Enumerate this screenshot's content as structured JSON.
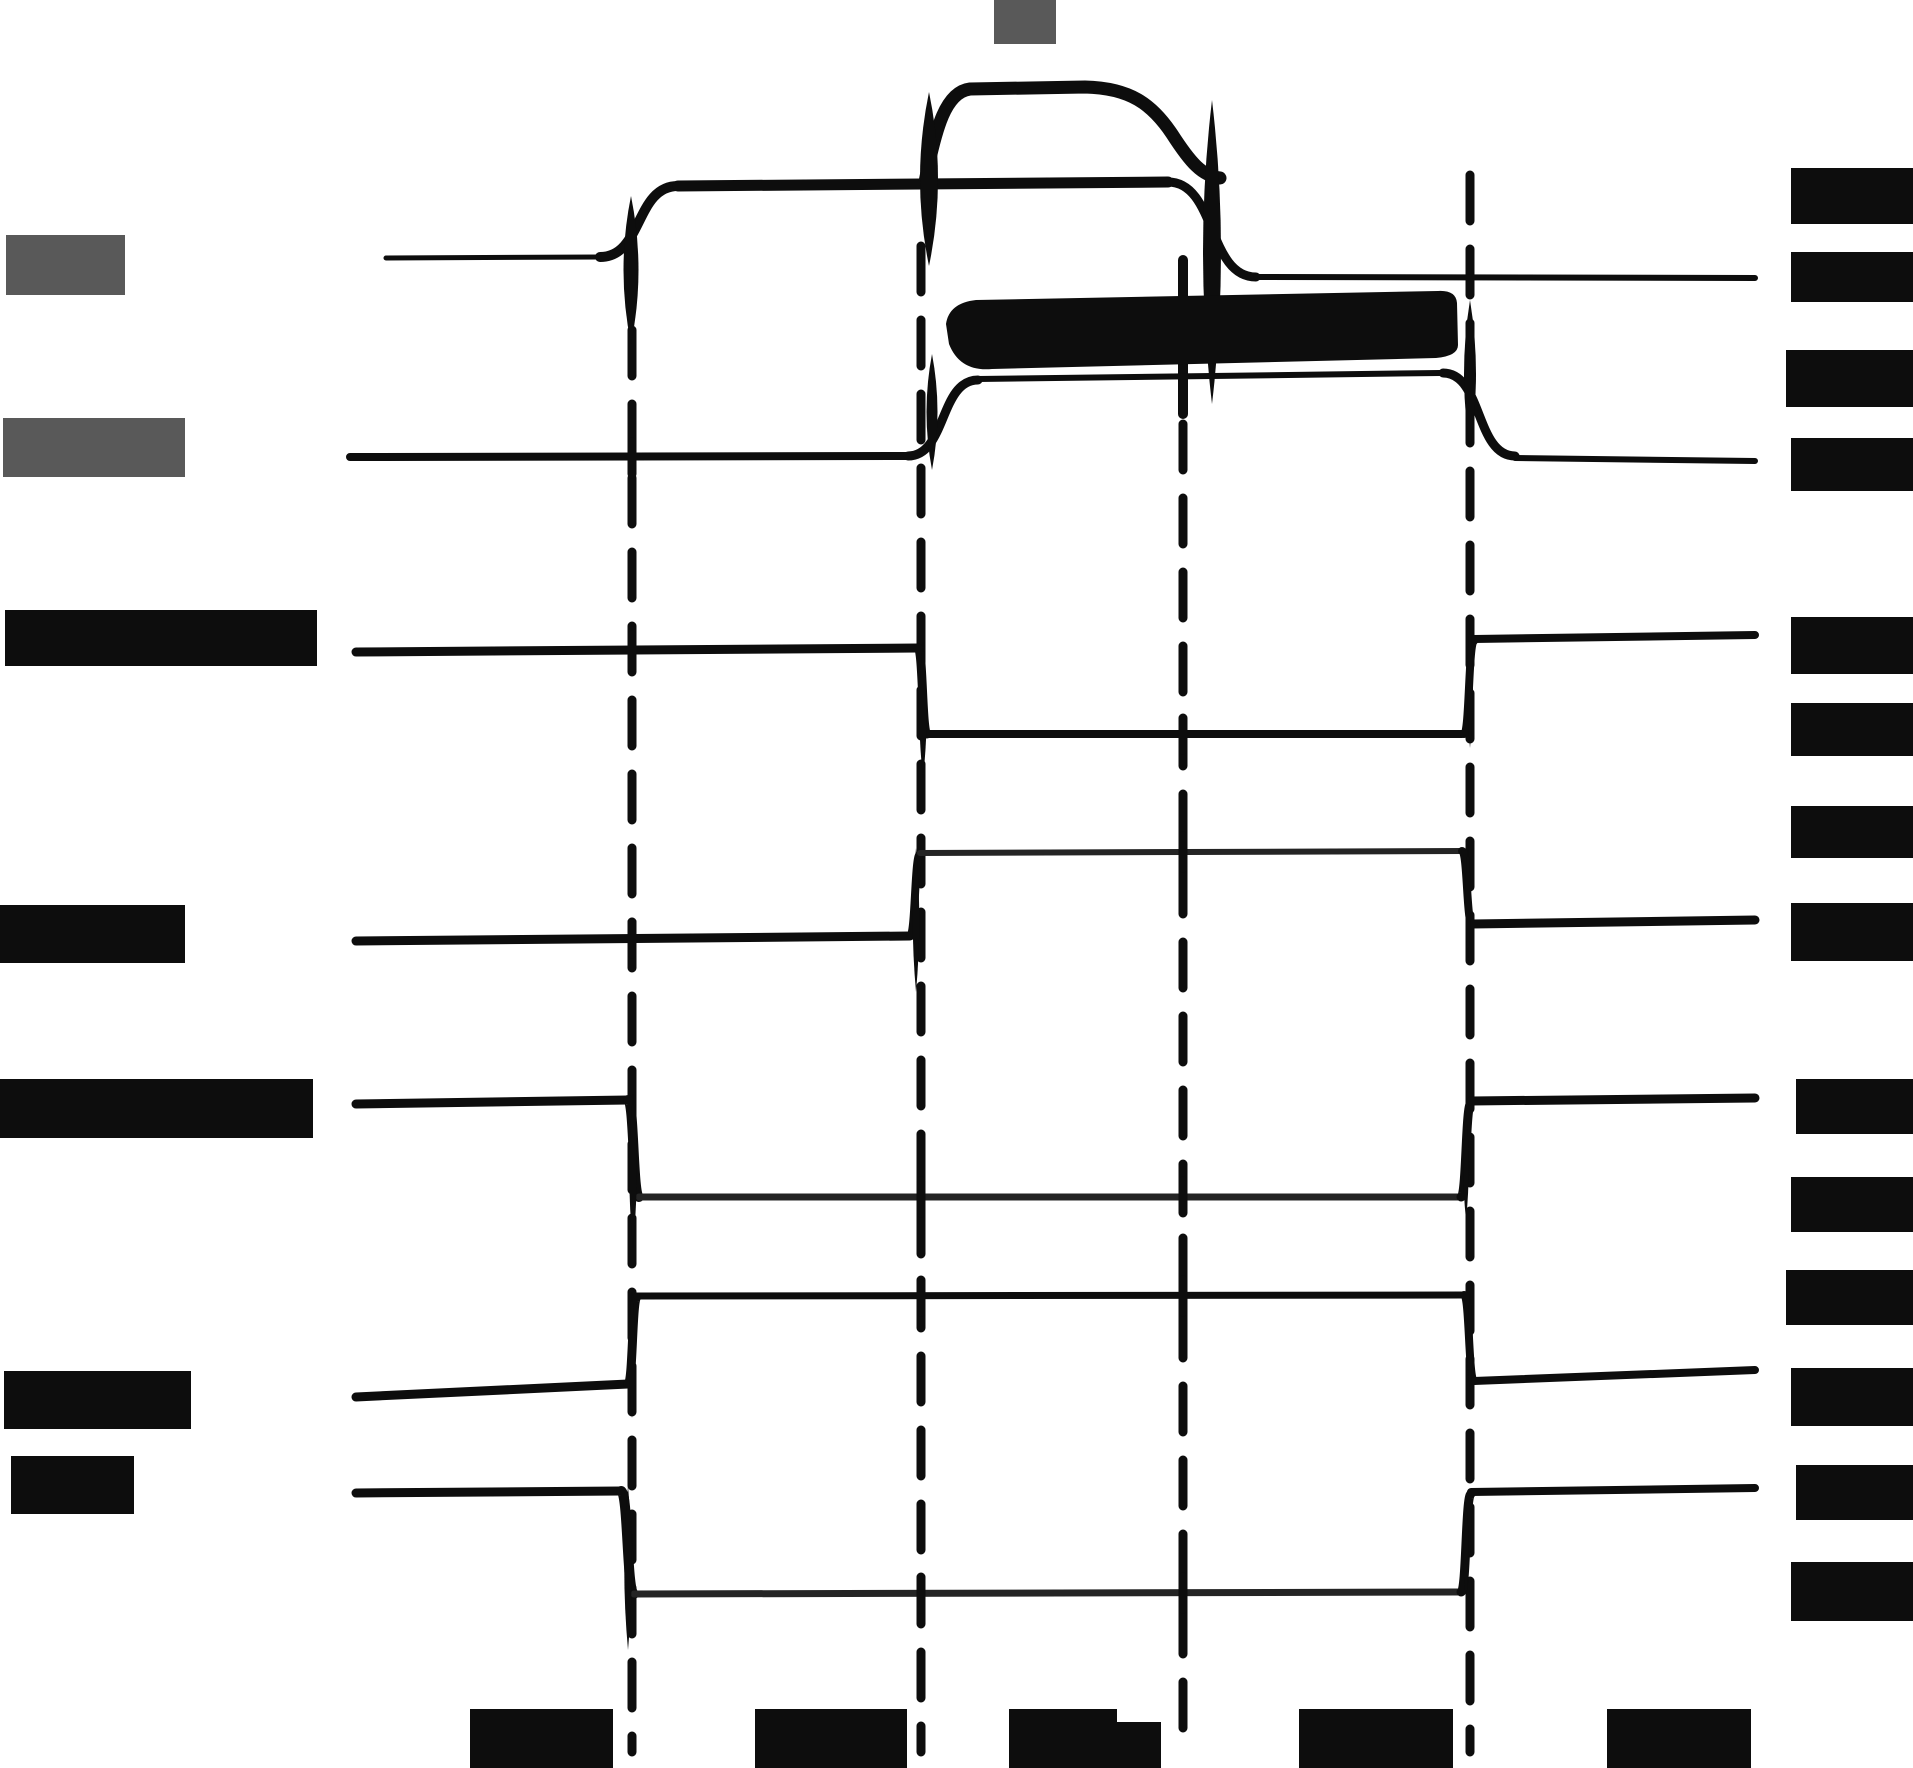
{
  "diagram": {
    "type": "scanned-timing-waveform-diagram",
    "width": 1913,
    "height": 1768,
    "background": "#ffffff",
    "visible_text": "none — every label in the scan is redacted with a solid block",
    "signal_count": 7,
    "timeline_marker_count": 4
  },
  "colors": {
    "ink": "#0d0d0d",
    "thin": "#242424",
    "gray_label": "#595959"
  },
  "timeline_markers": [
    {
      "x": 632,
      "from": 330,
      "to": 1752
    },
    {
      "x": 921,
      "from": 246,
      "to": 1752
    },
    {
      "x": 1183,
      "from": 424,
      "to": 1752,
      "solid": [
        260,
        414
      ]
    },
    {
      "x": 1470,
      "from": 175,
      "to": 1752
    }
  ],
  "crossing_ticks": [
    [
      632,
      458
    ],
    [
      632,
      651
    ],
    [
      632,
      938
    ],
    [
      921,
      1197
    ],
    [
      921,
      1296
    ],
    [
      921,
      1593
    ],
    [
      1183,
      734
    ],
    [
      1183,
      852
    ],
    [
      1183,
      1197
    ],
    [
      1183,
      1296
    ],
    [
      1183,
      1593
    ]
  ],
  "signals": [
    {
      "id": "signal-1-analog",
      "ops": [
        {
          "k": "line",
          "p": [
            386,
            258,
            600,
            257
          ],
          "w": 5
        },
        {
          "k": "edge",
          "p": [
            600,
            257,
            678,
            186
          ],
          "w": 10
        },
        {
          "k": "line",
          "p": [
            678,
            186,
            1168,
            182
          ],
          "w": 11
        },
        {
          "k": "edge",
          "p": [
            1168,
            182,
            1256,
            277
          ],
          "w": 9
        },
        {
          "k": "line",
          "p": [
            1256,
            277,
            1755,
            278
          ],
          "w": 6
        },
        {
          "k": "path",
          "d": "M 925 182 C 936 126 946 92 970 89 L 1085 87 C 1130 88 1152 104 1172 134 C 1190 162 1202 176 1220 178",
          "w": 13
        },
        {
          "k": "lens",
          "p": [
            631,
            196,
            344,
            30
          ]
        },
        {
          "k": "lens",
          "p": [
            929,
            92,
            266,
            36
          ]
        },
        {
          "k": "lens",
          "p": [
            1212,
            100,
            404,
            36
          ]
        }
      ]
    },
    {
      "id": "signal-2",
      "ops": [
        {
          "k": "line",
          "p": [
            350,
            457,
            908,
            456
          ],
          "w": 8
        },
        {
          "k": "edge",
          "p": [
            908,
            456,
            978,
            380
          ],
          "w": 9
        },
        {
          "k": "line",
          "p": [
            978,
            379,
            1440,
            373
          ],
          "w": 6
        },
        {
          "k": "edge",
          "p": [
            1443,
            373,
            1515,
            456
          ],
          "w": 9
        },
        {
          "k": "line",
          "p": [
            1515,
            458,
            1755,
            461
          ],
          "w": 6
        },
        {
          "k": "fill",
          "d": "M 946 324 Q 949 303 976 300 L 1438 291 Q 1456 290 1457 303 L 1458 345 Q 1458 356 1436 358 L 992 369 Q 960 372 949 344 Z"
        },
        {
          "k": "lens",
          "p": [
            932,
            354,
            470,
            22
          ]
        },
        {
          "k": "lens",
          "p": [
            1470,
            300,
            448,
            24
          ]
        }
      ]
    },
    {
      "id": "signal-3",
      "ops": [
        {
          "k": "line",
          "p": [
            356,
            652,
            918,
            648
          ],
          "w": 9
        },
        {
          "k": "edge",
          "p": [
            918,
            648,
            927,
            734
          ],
          "w": 9
        },
        {
          "k": "line",
          "p": [
            927,
            734,
            1462,
            734
          ],
          "w": 8
        },
        {
          "k": "edge",
          "p": [
            1464,
            734,
            1474,
            641
          ],
          "w": 8
        },
        {
          "k": "line",
          "p": [
            1474,
            639,
            1755,
            635
          ],
          "w": 8
        },
        {
          "k": "lens",
          "p": [
            923,
            642,
            778,
            15
          ]
        },
        {
          "k": "lens",
          "p": [
            1470,
            624,
            748,
            12
          ]
        }
      ]
    },
    {
      "id": "signal-4",
      "ops": [
        {
          "k": "line",
          "p": [
            356,
            941,
            910,
            936
          ],
          "w": 9
        },
        {
          "k": "edge",
          "p": [
            910,
            936,
            920,
            854
          ],
          "w": 8
        },
        {
          "k": "line",
          "p": [
            920,
            853,
            1462,
            851
          ],
          "w": 6,
          "c": "thin"
        },
        {
          "k": "edge",
          "p": [
            1462,
            851,
            1472,
            924
          ],
          "w": 8
        },
        {
          "k": "line",
          "p": [
            1472,
            924,
            1755,
            920
          ],
          "w": 9
        },
        {
          "k": "lens",
          "p": [
            916,
            848,
            992,
            13
          ]
        },
        {
          "k": "lens",
          "p": [
            1468,
            844,
            958,
            11
          ]
        }
      ]
    },
    {
      "id": "signal-5",
      "ops": [
        {
          "k": "line",
          "p": [
            356,
            1104,
            628,
            1100
          ],
          "w": 9
        },
        {
          "k": "edge",
          "p": [
            628,
            1100,
            639,
            1197
          ],
          "w": 10
        },
        {
          "k": "line",
          "p": [
            639,
            1197,
            1458,
            1197
          ],
          "w": 7,
          "c": "thin"
        },
        {
          "k": "edge",
          "p": [
            1461,
            1197,
            1471,
            1103
          ],
          "w": 9
        },
        {
          "k": "line",
          "p": [
            1471,
            1101,
            1755,
            1098
          ],
          "w": 9
        },
        {
          "k": "lens",
          "p": [
            633,
            1094,
            1248,
            15
          ]
        },
        {
          "k": "lens",
          "p": [
            1466,
            1112,
            1220,
            11
          ]
        }
      ]
    },
    {
      "id": "signal-6",
      "ops": [
        {
          "k": "line",
          "p": [
            356,
            1397,
            628,
            1384
          ],
          "w": 9
        },
        {
          "k": "edge",
          "p": [
            628,
            1384,
            637,
            1297
          ],
          "w": 9
        },
        {
          "k": "line",
          "p": [
            637,
            1296,
            1464,
            1295
          ],
          "w": 7
        },
        {
          "k": "edge",
          "p": [
            1464,
            1295,
            1474,
            1381
          ],
          "w": 8
        },
        {
          "k": "line",
          "p": [
            1474,
            1381,
            1755,
            1370
          ],
          "w": 8
        },
        {
          "k": "lens",
          "p": [
            632,
            1292,
            1418,
            13
          ]
        },
        {
          "k": "lens",
          "p": [
            1470,
            1294,
            1392,
            11
          ]
        }
      ]
    },
    {
      "id": "signal-7",
      "ops": [
        {
          "k": "line",
          "p": [
            356,
            1493,
            621,
            1491
          ],
          "w": 9
        },
        {
          "k": "edge",
          "p": [
            621,
            1491,
            634,
            1594
          ],
          "w": 10
        },
        {
          "k": "line",
          "p": [
            634,
            1594,
            1458,
            1592
          ],
          "w": 7,
          "c": "thin"
        },
        {
          "k": "edge",
          "p": [
            1461,
            1592,
            1471,
            1494
          ],
          "w": 9
        },
        {
          "k": "line",
          "p": [
            1471,
            1492,
            1755,
            1488
          ],
          "w": 8
        },
        {
          "k": "lens",
          "p": [
            628,
            1486,
            1650,
            15
          ]
        },
        {
          "k": "lens",
          "p": [
            1466,
            1502,
            1600,
            11
          ]
        }
      ]
    }
  ],
  "redacted_labels": {
    "top": [
      {
        "x": 994,
        "y": 0,
        "w": 62,
        "h": 44,
        "tone": "gray"
      }
    ],
    "left": [
      {
        "x": 6,
        "y": 235,
        "w": 119,
        "h": 60,
        "tone": "gray"
      },
      {
        "x": 3,
        "y": 418,
        "w": 182,
        "h": 59,
        "tone": "gray"
      },
      {
        "x": 5,
        "y": 610,
        "w": 312,
        "h": 56,
        "tone": "black"
      },
      {
        "x": 0,
        "y": 905,
        "w": 185,
        "h": 58,
        "tone": "black"
      },
      {
        "x": 0,
        "y": 1079,
        "w": 313,
        "h": 59,
        "tone": "black"
      },
      {
        "x": 4,
        "y": 1371,
        "w": 187,
        "h": 58,
        "tone": "black"
      },
      {
        "x": 11,
        "y": 1456,
        "w": 123,
        "h": 58,
        "tone": "black"
      }
    ],
    "right": [
      {
        "x": 1791,
        "y": 168,
        "w": 122,
        "h": 56,
        "tone": "black"
      },
      {
        "x": 1791,
        "y": 252,
        "w": 122,
        "h": 50,
        "tone": "black"
      },
      {
        "x": 1786,
        "y": 350,
        "w": 127,
        "h": 57,
        "tone": "black"
      },
      {
        "x": 1791,
        "y": 438,
        "w": 122,
        "h": 53,
        "tone": "black"
      },
      {
        "x": 1791,
        "y": 617,
        "w": 122,
        "h": 57,
        "tone": "black"
      },
      {
        "x": 1791,
        "y": 703,
        "w": 122,
        "h": 53,
        "tone": "black"
      },
      {
        "x": 1791,
        "y": 806,
        "w": 122,
        "h": 52,
        "tone": "black"
      },
      {
        "x": 1791,
        "y": 903,
        "w": 122,
        "h": 58,
        "tone": "black"
      },
      {
        "x": 1796,
        "y": 1079,
        "w": 117,
        "h": 55,
        "tone": "black"
      },
      {
        "x": 1791,
        "y": 1177,
        "w": 122,
        "h": 55,
        "tone": "black"
      },
      {
        "x": 1786,
        "y": 1270,
        "w": 127,
        "h": 55,
        "tone": "black"
      },
      {
        "x": 1791,
        "y": 1368,
        "w": 122,
        "h": 58,
        "tone": "black"
      },
      {
        "x": 1796,
        "y": 1465,
        "w": 117,
        "h": 55,
        "tone": "black"
      },
      {
        "x": 1791,
        "y": 1562,
        "w": 122,
        "h": 59,
        "tone": "black"
      }
    ],
    "bottom": [
      {
        "x": 470,
        "y": 1709,
        "w": 143,
        "h": 59,
        "tone": "black"
      },
      {
        "x": 755,
        "y": 1709,
        "w": 152,
        "h": 59,
        "tone": "black"
      },
      {
        "x": 1009,
        "y": 1709,
        "w": 108,
        "h": 59,
        "tone": "black"
      },
      {
        "x": 1117,
        "y": 1722,
        "w": 44,
        "h": 46,
        "tone": "black"
      },
      {
        "x": 1299,
        "y": 1709,
        "w": 154,
        "h": 59,
        "tone": "black"
      },
      {
        "x": 1607,
        "y": 1709,
        "w": 144,
        "h": 59,
        "tone": "black"
      }
    ]
  }
}
